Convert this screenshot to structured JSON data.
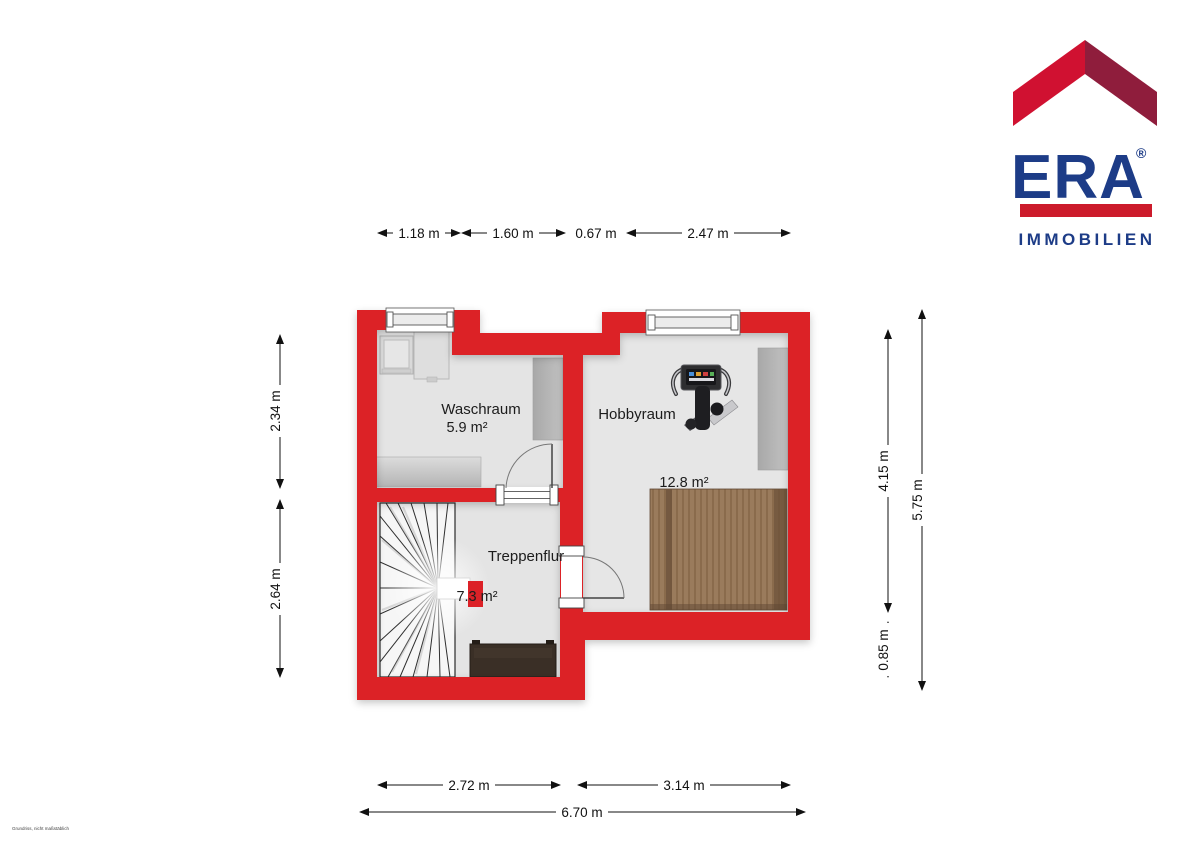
{
  "logo": {
    "name": "ERA",
    "registered": "®",
    "subtitle": "IMMOBILIEN"
  },
  "rooms": [
    {
      "name": "Waschraum",
      "area": "5.9 m²"
    },
    {
      "name": "Hobbyraum",
      "area": "12.8 m²"
    },
    {
      "name": "Treppenflur",
      "area": "7.3 m²"
    }
  ],
  "dimensions": {
    "top": [
      "1.18 m",
      "1.60 m",
      "0.67 m",
      "2.47 m"
    ],
    "left": [
      "2.34 m",
      "2.64 m"
    ],
    "right": [
      "4.15 m",
      "0.85 m",
      "5.75 m"
    ],
    "bottom": [
      "2.72 m",
      "3.14 m",
      "6.70 m"
    ]
  },
  "watermark": "Grundriss, nicht maßstäblich",
  "colors": {
    "wall": "#dc2127",
    "floor": "#e4e4e4",
    "logo_navy": "#1d3c87",
    "logo_red_bright": "#d01131",
    "logo_red_dark": "#8f1d3c",
    "logo_bar_red": "#cc1b2b",
    "wood": "#97785a"
  }
}
